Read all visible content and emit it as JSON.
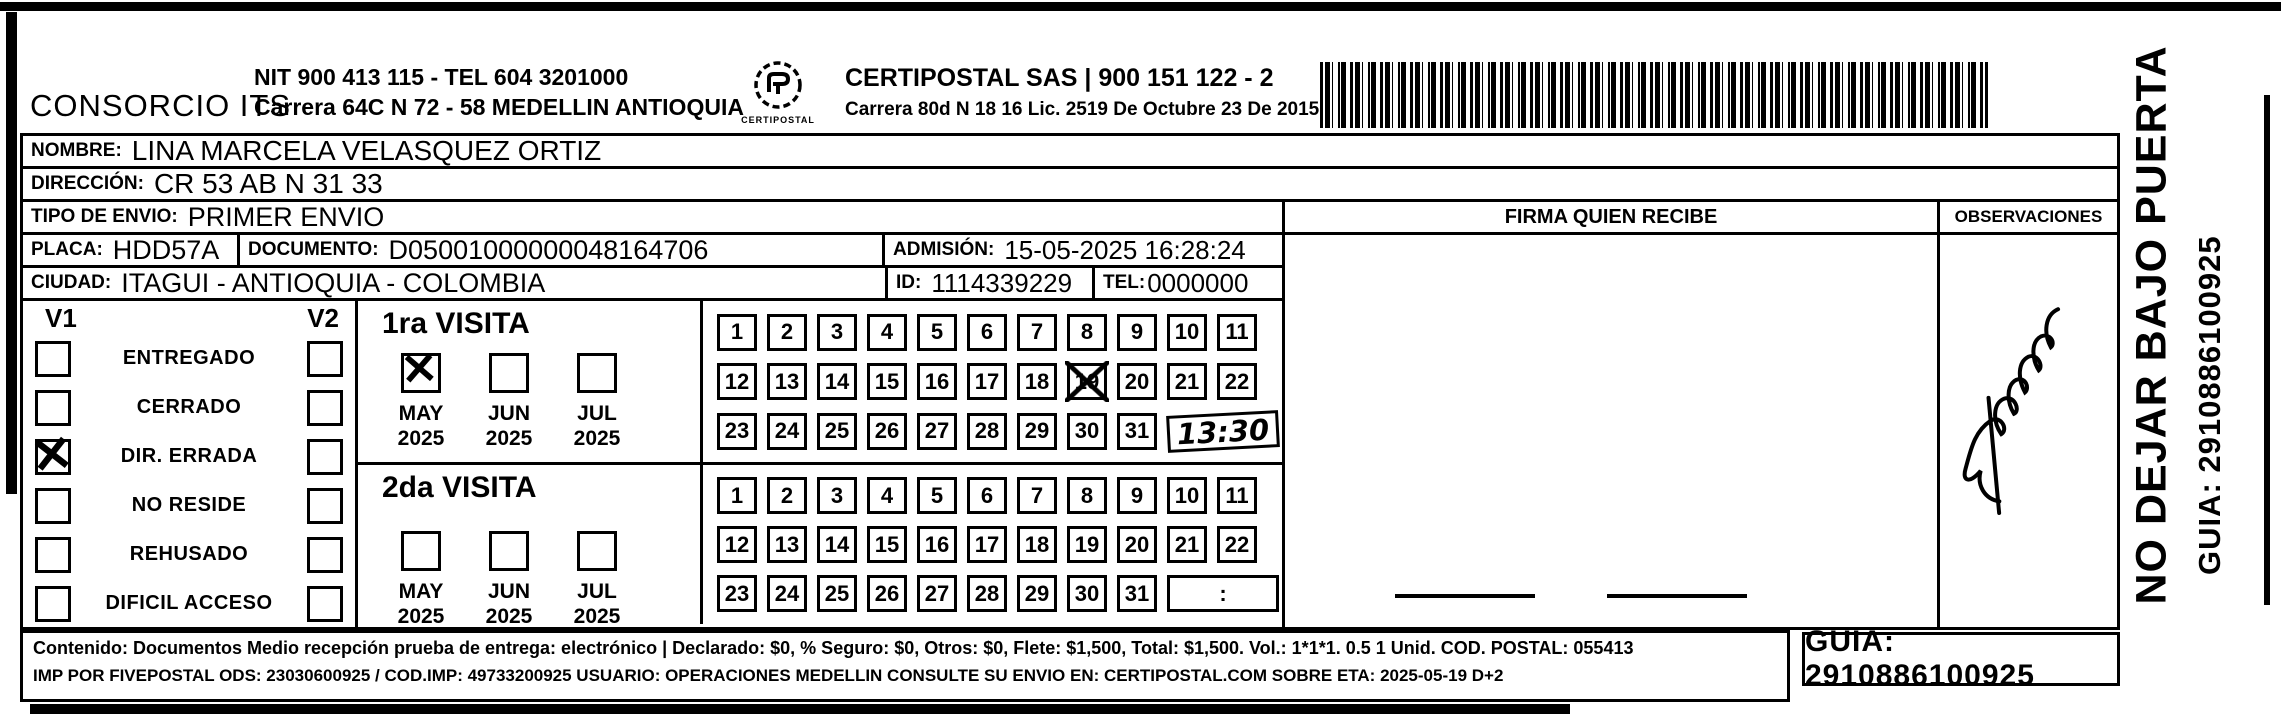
{
  "header": {
    "company": "CONSORCIO ITS",
    "nit_line": "NIT 900 413 115 - TEL 604 3201000",
    "address_line": "Carrera 64C N 72 - 58 MEDELLIN ANTIOQUIA",
    "logo_caption": "CERTIPOSTAL",
    "certipostal_name": "CERTIPOSTAL SAS | 900 151 122 - 2",
    "certipostal_address": "Carrera 80d N 18 16  Lic. 2519 De Octubre 23 De 2015"
  },
  "recipient": {
    "nombre_label": "NOMBRE:",
    "nombre": "LINA MARCELA VELASQUEZ ORTIZ",
    "direccion_label": "DIRECCIÓN:",
    "direccion": "CR 53 AB N 31 33",
    "tipo_envio_label": "TIPO DE ENVIO:",
    "tipo_envio": "PRIMER ENVIO",
    "placa_label": "PLACA:",
    "placa": "HDD57A",
    "documento_label": "DOCUMENTO:",
    "documento": "D05001000000048164706",
    "admision_label": "ADMISIÓN:",
    "admision": "15-05-2025 16:28:24",
    "ciudad_label": "CIUDAD:",
    "ciudad": "ITAGUI - ANTIOQUIA - COLOMBIA",
    "id_label": "ID:",
    "id": "1114339229",
    "tel_label": "TEL:",
    "tel": "0000000"
  },
  "status": {
    "v1_label": "V1",
    "v2_label": "V2",
    "items": [
      {
        "label": "ENTREGADO",
        "v1": false,
        "v2": false
      },
      {
        "label": "CERRADO",
        "v1": false,
        "v2": false
      },
      {
        "label": "DIR. ERRADA",
        "v1": true,
        "v2": false
      },
      {
        "label": "NO RESIDE",
        "v1": false,
        "v2": false
      },
      {
        "label": "REHUSADO",
        "v1": false,
        "v2": false
      },
      {
        "label": "DIFICIL ACCESO",
        "v1": false,
        "v2": false
      }
    ]
  },
  "visits": {
    "first": {
      "title": "1ra VISITA",
      "months": [
        {
          "label": "MAY",
          "year": "2025",
          "checked": true
        },
        {
          "label": "JUN",
          "year": "2025",
          "checked": false
        },
        {
          "label": "JUL",
          "year": "2025",
          "checked": false
        }
      ],
      "visit_time": "13:30",
      "crossed_day": "19",
      "day_rows": [
        [
          {
            "t": "1"
          },
          {
            "t": "2"
          },
          {
            "t": "3"
          },
          {
            "t": "4"
          },
          {
            "t": "5"
          },
          {
            "t": "6"
          },
          {
            "t": "7"
          },
          {
            "t": "8"
          },
          {
            "t": "9"
          },
          {
            "t": "10"
          },
          {
            "t": "11"
          }
        ],
        [
          {
            "t": "12"
          },
          {
            "t": "13"
          },
          {
            "t": "14"
          },
          {
            "t": "15"
          },
          {
            "t": "16"
          },
          {
            "t": "17"
          },
          {
            "t": "18"
          },
          {
            "t": "19",
            "x": true
          },
          {
            "t": "20"
          },
          {
            "t": "21"
          },
          {
            "t": "22"
          }
        ],
        [
          {
            "t": "23"
          },
          {
            "t": "24"
          },
          {
            "t": "25"
          },
          {
            "t": "26"
          },
          {
            "t": "27"
          },
          {
            "t": "28"
          },
          {
            "t": "29"
          },
          {
            "t": "30"
          },
          {
            "t": "31"
          },
          {
            "t": "13:30",
            "time": true,
            "hand": true
          }
        ]
      ]
    },
    "second": {
      "title": "2da VISITA",
      "months": [
        {
          "label": "MAY",
          "year": "2025",
          "checked": false
        },
        {
          "label": "JUN",
          "year": "2025",
          "checked": false
        },
        {
          "label": "JUL",
          "year": "2025",
          "checked": false
        }
      ],
      "visit_time": "",
      "day_rows": [
        [
          {
            "t": "1"
          },
          {
            "t": "2"
          },
          {
            "t": "3"
          },
          {
            "t": "4"
          },
          {
            "t": "5"
          },
          {
            "t": "6"
          },
          {
            "t": "7"
          },
          {
            "t": "8"
          },
          {
            "t": "9"
          },
          {
            "t": "10"
          },
          {
            "t": "11"
          }
        ],
        [
          {
            "t": "12"
          },
          {
            "t": "13"
          },
          {
            "t": "14"
          },
          {
            "t": "15"
          },
          {
            "t": "16"
          },
          {
            "t": "17"
          },
          {
            "t": "18"
          },
          {
            "t": "19"
          },
          {
            "t": "20"
          },
          {
            "t": "21"
          },
          {
            "t": "22"
          }
        ],
        [
          {
            "t": "23"
          },
          {
            "t": "24"
          },
          {
            "t": "25"
          },
          {
            "t": "26"
          },
          {
            "t": "27"
          },
          {
            "t": "28"
          },
          {
            "t": "29"
          },
          {
            "t": "30"
          },
          {
            "t": "31"
          },
          {
            "t": ":",
            "time": true
          }
        ]
      ]
    }
  },
  "firma": {
    "label": "FIRMA QUIEN RECIBE"
  },
  "observaciones": {
    "label": "OBSERVACIONES"
  },
  "footer": {
    "line1": "Contenido: Documentos Medio recepción prueba de entrega: electrónico | Declarado: $0, % Seguro: $0, Otros: $0, Flete: $1,500, Total: $1,500. Vol.: 1*1*1. 0.5  1 Unid. COD. POSTAL: 055413",
    "line2": "IMP POR FIVEPOSTAL ODS: 23030600925 / COD.IMP: 49733200925 USUARIO: OPERACIONES MEDELLIN CONSULTE SU ENVIO EN: CERTIPOSTAL.COM SOBRE ETA: 2025-05-19 D+2",
    "guia_box": "GUIA: 2910886100925"
  },
  "side": {
    "no_dejar": "NO DEJAR BAJO PUERTA",
    "guia_vertical": "GUIA: 2910886100925"
  }
}
